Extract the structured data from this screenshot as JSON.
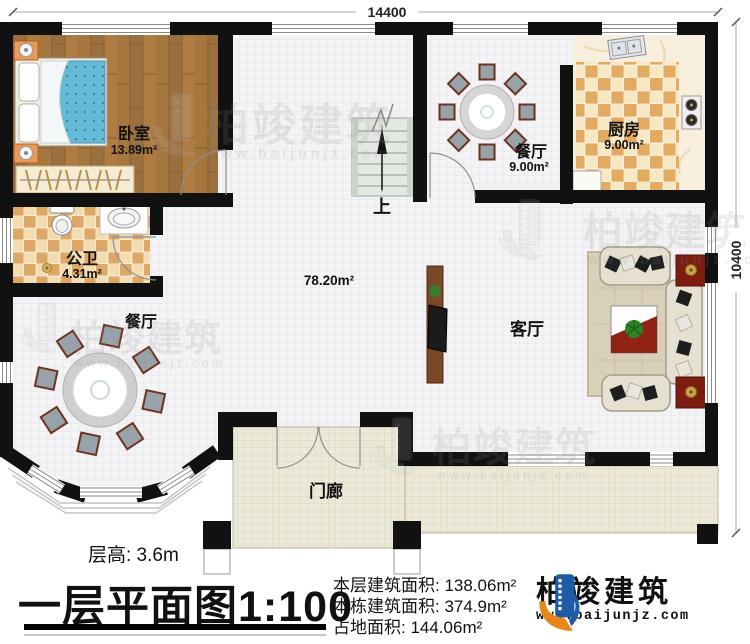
{
  "plan": {
    "dimensions": {
      "top": "14400",
      "right": "10400"
    },
    "rooms": {
      "bedroom": {
        "name": "卧室",
        "area": "13.89m²"
      },
      "bathroom": {
        "name": "公卫",
        "area": "4.31m²"
      },
      "dining_main": {
        "name": "餐厅"
      },
      "dining_small": {
        "name": "餐厅",
        "area": "9.00m²"
      },
      "kitchen": {
        "name": "厨房",
        "area": "9.00m²"
      },
      "living": {
        "name": "客厅"
      },
      "porch": {
        "name": "门廊"
      },
      "hall_area": "78.20m²",
      "stairs_up": "上"
    }
  },
  "title_block": {
    "floor_height": "层高: 3.6m",
    "plan_title": "一层平面图",
    "plan_scale": "1:100",
    "areas": {
      "floor": "本层建筑面积: 138.06m²",
      "building": "本栋建筑面积: 374.9m²",
      "footprint": "占地面积: 144.06m²"
    }
  },
  "brand": {
    "name": "柏竣建筑",
    "website": "www.baijunjz.com"
  },
  "watermark": {
    "name": "柏竣建筑",
    "website": "www.baijunjz.com"
  },
  "colors": {
    "wall": "#111111",
    "wood_floor": "#a5763e",
    "tile_tan": "#dda766",
    "porch_floor": "#ece9d8",
    "brand_blue": "#1e5ca6",
    "brand_orange": "#e8861c"
  }
}
